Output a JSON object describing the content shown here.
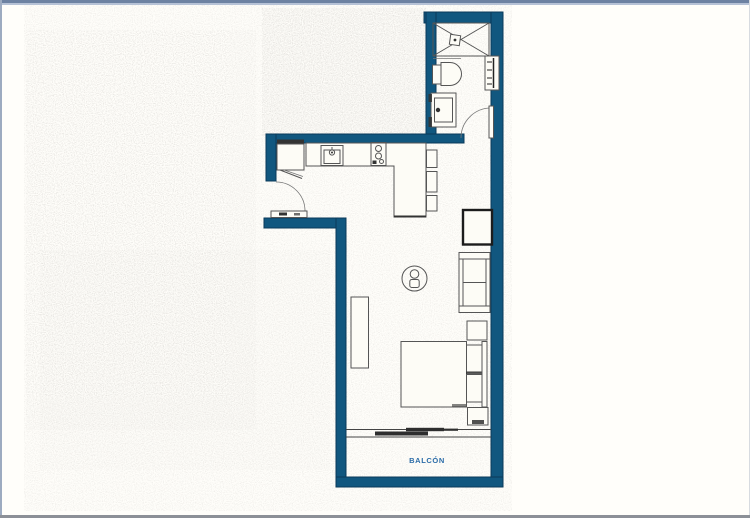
{
  "plan": {
    "balcony_label": "BALCÓN",
    "colors": {
      "wall": "#11577f",
      "wall_outline": "#0a3a5a",
      "furniture_line": "#555555",
      "label": "#2b6ca8",
      "paper": "#fffefa",
      "page_border_top": "#6d82a2",
      "page_border_bottom": "#8c9097"
    },
    "fixtures": [
      "shower",
      "toilet",
      "washbasin",
      "towel-radiator",
      "bathroom-door",
      "refrigerator",
      "kitchen-sink",
      "cooktop",
      "kitchen-counter-peninsula",
      "bar-stools",
      "entry-door",
      "tv-unit",
      "sofa",
      "dining-table",
      "sideboard",
      "double-bed",
      "pillows",
      "nightstands",
      "sliding-balcony-door",
      "balcony"
    ]
  }
}
